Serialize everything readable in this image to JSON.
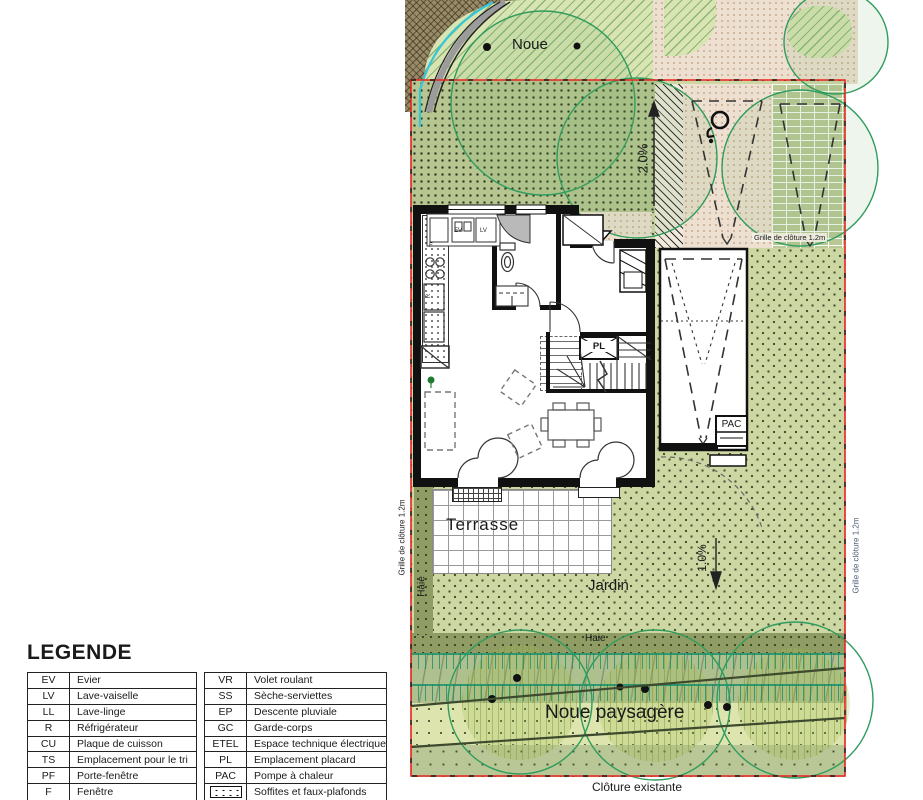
{
  "site": {
    "labels": {
      "noue": "Noue",
      "slope_top": "2.0%",
      "slope_garden": "1.0%",
      "grille_cloture_top": "Grille de clôture 1.2m",
      "grille_cloture_left": "Grille de clôture 1.2m",
      "grille_cloture_right": "Grille de clôture 1.2m",
      "terrasse": "Terrasse",
      "jardin": "Jardin",
      "haie_left": "Haie",
      "haie_bottom": "Haie",
      "noue_paysagere": "Noue paysagère",
      "cloture_existante": "Clôture existante"
    },
    "house_labels": {
      "pl": "PL",
      "pac": "PAC",
      "ev": "EV",
      "lv": "LV",
      "r": "R",
      "f": "F"
    }
  },
  "legend": {
    "title": "LEGENDE",
    "left": [
      {
        "code": "EV",
        "label": "Evier"
      },
      {
        "code": "LV",
        "label": "Lave-vaiselle"
      },
      {
        "code": "LL",
        "label": "Lave-linge"
      },
      {
        "code": "R",
        "label": "Réfrigérateur"
      },
      {
        "code": "CU",
        "label": "Plaque de cuisson"
      },
      {
        "code": "TS",
        "label": "Emplacement pour le tri"
      },
      {
        "code": "PF",
        "label": "Porte-fenêtre"
      },
      {
        "code": "F",
        "label": "Fenêtre"
      }
    ],
    "right": [
      {
        "code": "VR",
        "label": "Volet roulant"
      },
      {
        "code": "SS",
        "label": "Sèche-serviettes"
      },
      {
        "code": "EP",
        "label": "Descente pluviale"
      },
      {
        "code": "GC",
        "label": "Garde-corps"
      },
      {
        "code": "ETEL",
        "label": "Espace technique électrique"
      },
      {
        "code": "PL",
        "label": "Emplacement placard"
      },
      {
        "code": "PAC",
        "label": "Pompe à chaleur"
      },
      {
        "code": "",
        "label": "Soffites et faux-plafonds"
      }
    ]
  },
  "colors": {
    "boundary_red": "#e8241f",
    "lawn_green": "#cdd7a4",
    "noue_green": "#d8e4b2",
    "water_cyan": "#35c6d9",
    "canopy_green": "#2f9c5d"
  }
}
